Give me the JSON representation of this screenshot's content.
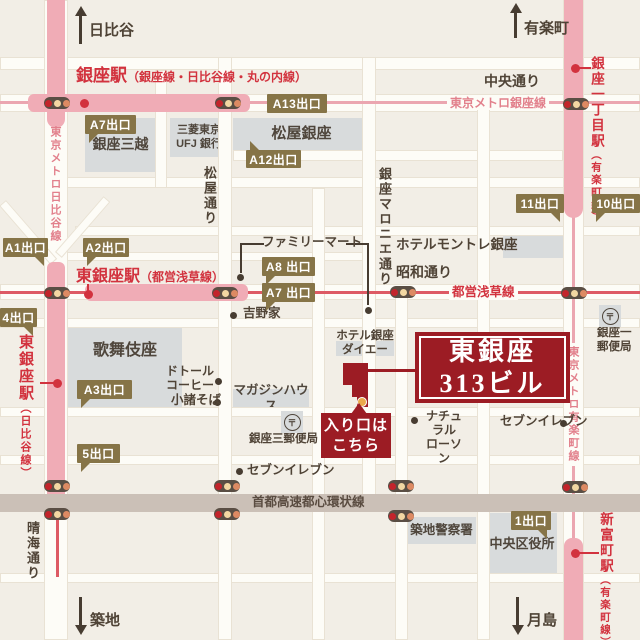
{
  "colors": {
    "accent_red": "#9c1c24",
    "station_red": "#d2323e",
    "metro_pink_band": "#f0acb6",
    "metro_pink_text": "#e2808c",
    "exit_olive": "#867447",
    "building_grey": "#d8dbdc",
    "ink": "#4f4336",
    "highway_grey": "#cbc0b7"
  },
  "destination": {
    "name_line1": "東銀座",
    "name_line2": "313ビル",
    "entrance_line1": "入り口は",
    "entrance_line2": "こちら"
  },
  "roads": [
    {
      "x": 0,
      "y": 57,
      "w": 640,
      "h": 13
    },
    {
      "x": 0,
      "y": 94,
      "w": 640,
      "h": 18
    },
    {
      "x": 233,
      "y": 150,
      "w": 330,
      "h": 11
    },
    {
      "x": 62,
      "y": 177,
      "w": 578,
      "h": 11
    },
    {
      "x": 75,
      "y": 226,
      "w": 565,
      "h": 10
    },
    {
      "x": 62,
      "y": 252,
      "w": 312,
      "h": 9
    },
    {
      "x": 0,
      "y": 284,
      "w": 640,
      "h": 16
    },
    {
      "x": 0,
      "y": 318,
      "w": 640,
      "h": 10
    },
    {
      "x": 0,
      "y": 407,
      "w": 640,
      "h": 10
    },
    {
      "x": 0,
      "y": 455,
      "w": 640,
      "h": 10
    },
    {
      "x": 0,
      "y": 573,
      "w": 640,
      "h": 10
    },
    {
      "x": 44,
      "y": 0,
      "w": 24,
      "h": 640
    },
    {
      "x": 155,
      "y": 70,
      "w": 12,
      "h": 118
    },
    {
      "x": 218,
      "y": 57,
      "w": 14,
      "h": 583
    },
    {
      "x": 312,
      "y": 188,
      "w": 13,
      "h": 452
    },
    {
      "x": 362,
      "y": 57,
      "w": 14,
      "h": 440
    },
    {
      "x": 395,
      "y": 294,
      "w": 13,
      "h": 346
    },
    {
      "x": 477,
      "y": 107,
      "w": 13,
      "h": 533
    },
    {
      "x": 563,
      "y": 0,
      "w": 21,
      "h": 640
    }
  ],
  "diagonals": [
    {
      "x": 6,
      "y": 200,
      "w": 78,
      "h": 9,
      "a": 49
    },
    {
      "x": 55,
      "y": 252,
      "w": 74,
      "h": 9,
      "a": -49
    }
  ],
  "expressway": {
    "x": 0,
    "y": 494,
    "w": 640,
    "h": 18
  },
  "metro_lines": [
    {
      "name": "ginza-metro-line",
      "x": 0,
      "y": 101,
      "w": 640,
      "h": 3,
      "c": "#eba6b0"
    },
    {
      "name": "yurakucho-metro-line",
      "x": 572,
      "y": 210,
      "w": 3,
      "h": 332,
      "c": "#eba6b0"
    },
    {
      "name": "asakusa-metro-line",
      "x": 0,
      "y": 291,
      "w": 640,
      "h": 3,
      "c": "#dd5a64"
    },
    {
      "name": "hibiya-metro-line",
      "x": 56,
      "y": 515,
      "w": 3,
      "h": 62,
      "c": "#dd5a64"
    }
  ],
  "bands": [
    {
      "name": "ginza-station-band-v",
      "x": 47,
      "y": 0,
      "w": 18,
      "h": 128,
      "r": "0 0 9px 9px"
    },
    {
      "name": "ginza-station-band-h",
      "x": 28,
      "y": 94,
      "w": 222,
      "h": 18,
      "r": "6px"
    },
    {
      "name": "higashi-ginza-station-band-v",
      "x": 47,
      "y": 262,
      "w": 18,
      "h": 256,
      "r": "6px 6px 0 0"
    },
    {
      "name": "higashi-ginza-station-band-h",
      "x": 85,
      "y": 284,
      "w": 163,
      "h": 17,
      "r": "6px"
    },
    {
      "name": "ginza-itchome-station-band",
      "x": 564,
      "y": 0,
      "w": 19,
      "h": 218,
      "r": "0 0 10px 10px"
    },
    {
      "name": "shintomicho-station-band",
      "x": 564,
      "y": 538,
      "w": 19,
      "h": 102,
      "r": "8px 8px 0 0"
    }
  ],
  "pointer_lines": [
    {
      "name": "familymart-pointer-left-h",
      "x": 240,
      "y": 243,
      "w": 24,
      "h": 2,
      "c": "#473c31"
    },
    {
      "name": "familymart-pointer-left-v",
      "x": 240,
      "y": 243,
      "w": 2,
      "h": 30,
      "c": "#473c31"
    },
    {
      "name": "familymart-pointer-right-h",
      "x": 346,
      "y": 243,
      "w": 23,
      "h": 2,
      "c": "#473c31"
    },
    {
      "name": "familymart-pointer-right-v",
      "x": 367,
      "y": 243,
      "w": 2,
      "h": 62,
      "c": "#473c31"
    },
    {
      "name": "higashi-ginza-dot-stem",
      "x": 87,
      "y": 284,
      "w": 2,
      "h": 11,
      "c": "#d2323e"
    },
    {
      "name": "higashi-ginza-hibiya-pointer",
      "x": 40,
      "y": 382,
      "w": 16,
      "h": 2,
      "c": "#d2323e"
    },
    {
      "name": "ginza-itchome-pointer",
      "x": 577,
      "y": 67,
      "w": 14,
      "h": 2,
      "c": "#d2323e"
    },
    {
      "name": "shintomicho-pointer",
      "x": 577,
      "y": 552,
      "w": 22,
      "h": 2,
      "c": "#d2323e"
    },
    {
      "name": "destination-pointer",
      "x": 368,
      "y": 369,
      "w": 47,
      "h": 3,
      "c": "#9c1c24"
    }
  ],
  "traffic_lights": [
    {
      "x": 57,
      "y": 103
    },
    {
      "x": 228,
      "y": 103
    },
    {
      "x": 576,
      "y": 104
    },
    {
      "x": 57,
      "y": 293
    },
    {
      "x": 225,
      "y": 293
    },
    {
      "x": 403,
      "y": 292
    },
    {
      "x": 574,
      "y": 293
    },
    {
      "x": 57,
      "y": 486
    },
    {
      "x": 57,
      "y": 514
    },
    {
      "x": 227,
      "y": 486
    },
    {
      "x": 227,
      "y": 514
    },
    {
      "x": 401,
      "y": 486
    },
    {
      "x": 401,
      "y": 516
    },
    {
      "x": 575,
      "y": 487
    }
  ],
  "light_colors": [
    "#c3242b",
    "#f2d7a2",
    "#dd8a63"
  ],
  "station_dots": [
    {
      "name": "ginza-station-dot",
      "x": 84,
      "y": 103
    },
    {
      "name": "higashi-ginza-station-dot",
      "x": 88,
      "y": 294
    },
    {
      "name": "higashi-ginza-hibiya-dot",
      "x": 57,
      "y": 383
    },
    {
      "name": "ginza-itchome-station-dot",
      "x": 575,
      "y": 68
    },
    {
      "name": "shintomicho-station-dot",
      "x": 575,
      "y": 553
    }
  ],
  "poi_dots": [
    {
      "x": 240,
      "y": 277
    },
    {
      "x": 368,
      "y": 310
    },
    {
      "x": 233,
      "y": 315
    },
    {
      "x": 218,
      "y": 381
    },
    {
      "x": 217,
      "y": 402
    },
    {
      "x": 239,
      "y": 471
    },
    {
      "x": 414,
      "y": 420
    },
    {
      "x": 563,
      "y": 423
    }
  ],
  "blocks": [
    {
      "label": "銀座三越",
      "x": 85,
      "y": 118,
      "w": 71,
      "h": 54,
      "size": 14
    },
    {
      "lines": [
        "三菱東京",
        "UFJ 銀行"
      ],
      "x": 170,
      "y": 118,
      "w": 58,
      "h": 39,
      "size": 11
    },
    {
      "label": "松屋銀座",
      "x": 233,
      "y": 118,
      "w": 137,
      "h": 33,
      "size": 15
    },
    {
      "label": "歌舞伎座",
      "x": 68,
      "y": 327,
      "w": 114,
      "h": 83,
      "size": 16,
      "top": 14
    },
    {
      "label": "マガジンハウス",
      "x": 233,
      "y": 389,
      "w": 76,
      "h": 19,
      "size": 12.5
    },
    {
      "label": "",
      "x": 503,
      "y": 234,
      "w": 65,
      "h": 24
    },
    {
      "label": "",
      "x": 336,
      "y": 341,
      "w": 58,
      "h": 15
    },
    {
      "label": "築地警察署",
      "x": 407,
      "y": 517,
      "w": 69,
      "h": 27,
      "size": 12.5
    },
    {
      "label": "中央区役所",
      "x": 487,
      "y": 513,
      "w": 70,
      "h": 63,
      "size": 13
    }
  ],
  "stations": [
    {
      "name": "銀座駅",
      "sub": "（銀座線・日比谷線・丸の内線）",
      "x": 76,
      "y": 66,
      "vert": false,
      "nsize": 17,
      "ssize": 12
    },
    {
      "name": "東銀座駅",
      "sub": "（都営浅草線）",
      "x": 76,
      "y": 268,
      "vert": false,
      "nsize": 16,
      "ssize": 12
    },
    {
      "name": "東銀座駅",
      "sub": "（日比谷線）",
      "x": 17,
      "y": 334,
      "vert": true,
      "nsize": 15,
      "ssize": 11
    },
    {
      "name": "銀座一丁目駅",
      "sub": "（有楽町線）",
      "x": 588,
      "y": 56,
      "vert": true,
      "nsize": 13.5,
      "ssize": 10.5
    },
    {
      "name": "新富町駅",
      "sub": "（有楽町線）",
      "x": 597,
      "y": 512,
      "vert": true,
      "nsize": 13.5,
      "ssize": 10.5
    }
  ],
  "texts": [
    {
      "lines": [
        "日比谷"
      ],
      "x": 89,
      "y": 22,
      "size": 15,
      "c": "ink"
    },
    {
      "lines": [
        "有楽町"
      ],
      "x": 524,
      "y": 20,
      "size": 15,
      "c": "ink"
    },
    {
      "lines": [
        "中央通り"
      ],
      "x": 484,
      "y": 73,
      "size": 14,
      "c": "ink"
    },
    {
      "lines": [
        "松屋通り"
      ],
      "x": 203,
      "y": 166,
      "size": 13,
      "c": "ink",
      "vert": true
    },
    {
      "lines": [
        "銀座マロニエ通り"
      ],
      "x": 378,
      "y": 167,
      "size": 13,
      "c": "ink",
      "vert": true
    },
    {
      "lines": [
        "昭和通り"
      ],
      "x": 396,
      "y": 264,
      "size": 14,
      "c": "ink"
    },
    {
      "lines": [
        "晴海通り"
      ],
      "x": 26,
      "y": 521,
      "size": 13,
      "c": "ink",
      "vert": true
    },
    {
      "lines": [
        "築地"
      ],
      "x": 90,
      "y": 612,
      "size": 15,
      "c": "ink"
    },
    {
      "lines": [
        "月島"
      ],
      "x": 527,
      "y": 612,
      "size": 15,
      "c": "ink"
    },
    {
      "lines": [
        "首都高速都心環状線"
      ],
      "x": 252,
      "y": 495,
      "size": 12.5,
      "c": "hwytxt"
    },
    {
      "lines": [
        "東京メトロ銀座線"
      ],
      "x": 447,
      "y": 96,
      "size": 12,
      "c": "pink",
      "bg": true
    },
    {
      "lines": [
        "東京メトロ日比谷線"
      ],
      "x": 49,
      "y": 126,
      "size": 11,
      "c": "pink",
      "vert": true
    },
    {
      "lines": [
        "東京メトロ有楽町線"
      ],
      "x": 567,
      "y": 343,
      "size": 11,
      "c": "pink",
      "vert": true,
      "bg": true
    },
    {
      "lines": [
        "都営浅草線"
      ],
      "x": 449,
      "y": 285,
      "size": 12.5,
      "c": "crimson",
      "bg": true
    },
    {
      "lines": [
        "ホテルモントレ銀座"
      ],
      "x": 396,
      "y": 237,
      "size": 13.5,
      "c": "ink"
    },
    {
      "lines": [
        "ホテル銀座",
        "ダイエー"
      ],
      "x": 334,
      "y": 330,
      "size": 11.5,
      "c": "ink",
      "align": "center",
      "w": 62
    },
    {
      "lines": [
        "銀座三郵便局"
      ],
      "x": 249,
      "y": 433,
      "size": 11.5,
      "c": "ink"
    },
    {
      "lines": [
        "銀座一",
        "郵便局"
      ],
      "x": 597,
      "y": 327,
      "size": 11.5,
      "c": "ink"
    }
  ],
  "pois": [
    {
      "lines": [
        "ファミリーマート"
      ],
      "x": 262,
      "y": 235,
      "size": 12.5
    },
    {
      "lines": [
        "吉野家"
      ],
      "x": 243,
      "y": 306,
      "size": 12.5
    },
    {
      "lines": [
        "ドトール",
        "コーヒー"
      ],
      "x": 166,
      "y": 364,
      "size": 12,
      "align": "right",
      "w": 48
    },
    {
      "lines": [
        "小諸そば"
      ],
      "x": 171,
      "y": 393,
      "size": 12.5
    },
    {
      "lines": [
        "セブンイレブン"
      ],
      "x": 247,
      "y": 463,
      "size": 12.5
    },
    {
      "lines": [
        "ナチュラル",
        "ローソン"
      ],
      "x": 421,
      "y": 409,
      "size": 12,
      "align": "center",
      "w": 46
    },
    {
      "lines": [
        "セブンイレブン"
      ],
      "x": 500,
      "y": 414,
      "size": 12.5
    }
  ],
  "badges": [
    {
      "t": "A7出口",
      "x": 85,
      "y": 115,
      "w": 51,
      "h": 19,
      "tail": "bl"
    },
    {
      "t": "A13出口",
      "x": 267,
      "y": 94,
      "w": 60,
      "h": 19,
      "tail": ""
    },
    {
      "t": "A12出口",
      "x": 246,
      "y": 150,
      "w": 55,
      "h": 18,
      "tail": "tl"
    },
    {
      "t": "A1出口",
      "x": 3,
      "y": 238,
      "w": 45,
      "h": 19,
      "tail": "br"
    },
    {
      "t": "A2出口",
      "x": 83,
      "y": 238,
      "w": 46,
      "h": 19,
      "tail": "bl"
    },
    {
      "t": "A8 出口",
      "x": 262,
      "y": 257,
      "w": 53,
      "h": 19,
      "tail": "bl"
    },
    {
      "t": "A7 出口",
      "x": 262,
      "y": 283,
      "w": 53,
      "h": 19,
      "tail": "bl"
    },
    {
      "t": "4出口",
      "x": 0,
      "y": 308,
      "w": 37,
      "h": 19,
      "tail": "br"
    },
    {
      "t": "A3出口",
      "x": 77,
      "y": 380,
      "w": 55,
      "h": 19,
      "tail": "bl"
    },
    {
      "t": "5出口",
      "x": 77,
      "y": 444,
      "w": 43,
      "h": 19,
      "tail": "bl"
    },
    {
      "t": "11出口",
      "x": 516,
      "y": 194,
      "w": 48,
      "h": 19,
      "tail": "br"
    },
    {
      "t": "10出口",
      "x": 592,
      "y": 194,
      "w": 48,
      "h": 19,
      "tail": "bl"
    },
    {
      "t": "1出口",
      "x": 511,
      "y": 511,
      "w": 40,
      "h": 19,
      "tail": "br"
    }
  ],
  "post_offices": [
    {
      "symbol": "〒",
      "x": 281,
      "y": 411
    },
    {
      "symbol": "〒",
      "x": 599,
      "y": 305
    }
  ],
  "arrows": [
    {
      "name": "arrow-up-hibiya",
      "dir": "up",
      "x": 79,
      "y": 6,
      "h": 38
    },
    {
      "name": "arrow-up-yurakucho",
      "dir": "up",
      "x": 514,
      "y": 3,
      "h": 35
    },
    {
      "name": "arrow-down-tsukiji",
      "dir": "down",
      "x": 79,
      "y": 597,
      "h": 38
    },
    {
      "name": "arrow-down-tsukishima",
      "dir": "down",
      "x": 516,
      "y": 597,
      "h": 38
    }
  ]
}
